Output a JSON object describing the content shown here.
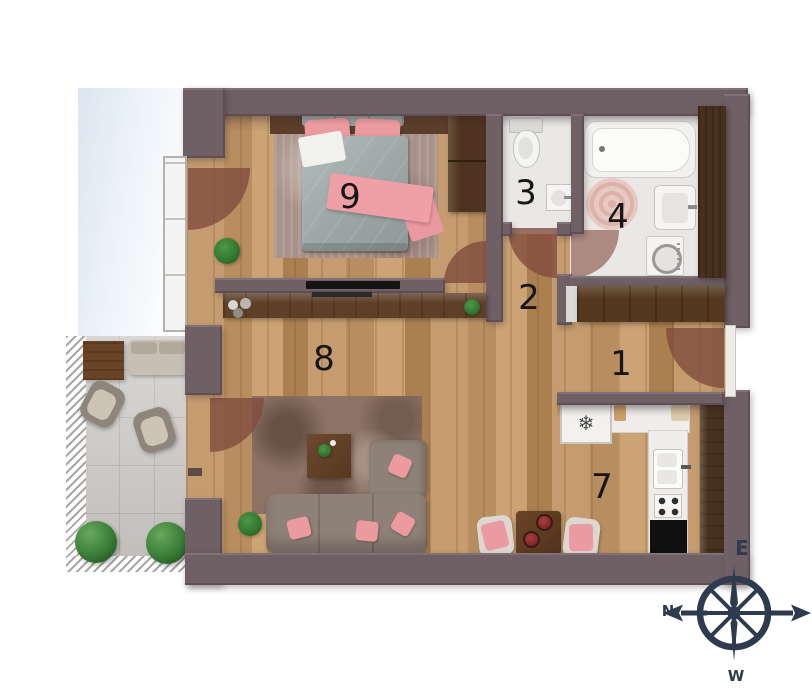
{
  "title": "apartment-floor-plan",
  "rooms": [
    {
      "number": "1",
      "type": "entrance-hall"
    },
    {
      "number": "2",
      "type": "hallway"
    },
    {
      "number": "3",
      "type": "toilet"
    },
    {
      "number": "4",
      "type": "bathroom"
    },
    {
      "number": "7",
      "type": "kitchen"
    },
    {
      "number": "8",
      "type": "living-room"
    },
    {
      "number": "9",
      "type": "bedroom"
    }
  ],
  "compass": {
    "top": "E",
    "left": "N",
    "right": "S",
    "bottom": "W"
  },
  "icons": {
    "fridge-snowflake": "❄"
  },
  "colors": {
    "wall": "#6f6065",
    "wood_floor": "#c19a6c",
    "accent_pink": "#eb9aa1",
    "compass": "#2e3a4e",
    "terrace_tile": "#cbc8c5",
    "dark_wood": "#4e3420"
  }
}
